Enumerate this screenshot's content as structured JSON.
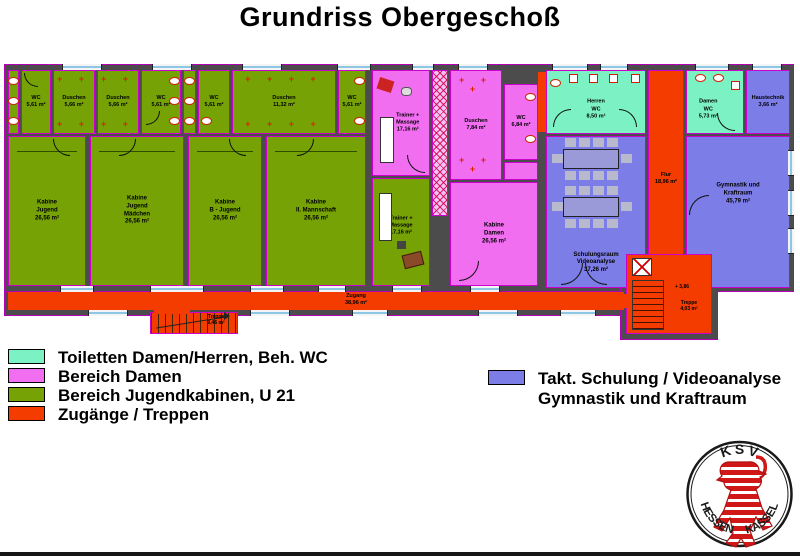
{
  "title": "Grundriss Obergeschoß",
  "palette": {
    "toiletten": "#7cf2c4",
    "damen": "#f16ef1",
    "jugend": "#76a206",
    "zugang": "#f43c00",
    "schulung": "#7d7de8",
    "wall": "#4c4c4c",
    "room_border": "#cc00cc",
    "window_glass": "#8ec6e6"
  },
  "legend": {
    "items": [
      {
        "label": "Toiletten Damen/Herren, Beh. WC",
        "key": "toiletten"
      },
      {
        "label": "Bereich Damen",
        "key": "damen"
      },
      {
        "label": "Bereich Jugendkabinen, U 21",
        "key": "jugend"
      },
      {
        "label": "Zugänge / Treppen",
        "key": "zugang"
      }
    ],
    "right": {
      "line1": "Takt. Schulung / Videoanalyse",
      "line2": "Gymnastik und Kraftraum",
      "key": "schulung"
    }
  },
  "rooms": {
    "wc1": "WC\n5,61 m²",
    "du1": "Duschen\n5,66 m²",
    "du2": "Duschen\n5,66 m²",
    "wc2": "WC\n5,61 m²",
    "wc3": "WC\n5,61 m²",
    "du_big": "Duschen\n11,32 m²",
    "wc4": "WC\n5,61 m²",
    "kab1": "Kabine\nJugend\n26,56 m²",
    "kab2": "Kabine\nJugend\nMädchen\n26,56 m²",
    "kab3": "Kabine\nB - Jugend\n26,56 m²",
    "kab4": "Kabine\nII. Mannschaft\n26,56 m²",
    "trainer1": "Trainer +\nMassage\n17,16 m²",
    "trainer2": "Trainer +\nMassage\n17,16 m²",
    "du_damen": "Duschen\n7,84 m²",
    "wc_damen": "WC\n6,84 m²",
    "kab_damen": "Kabine\nDamen\n26,56 m²",
    "herren_wc": "Herren\nWC\n8,50 m²",
    "damen_wc": "Damen\nWC\n5,73 m²",
    "haustechnik": "Haustechnik\n3,66 m²",
    "flur": "Flur\n18,96 m²",
    "schulungsraum": "Schulungsraum\nVideoanalyse\n37,26 m²",
    "gymnastik": "Gymnastik und\nKraftraum\n45,79 m²",
    "zugang": "Zugang\n38,96 m²",
    "treppe_links": "Treppe\n9,46 m²",
    "treppe_rechts": "Treppe\n4,03 m²"
  },
  "annotations": {
    "level": "+ 3,86"
  },
  "symbols": {
    "row2": "+ +",
    "row3": "+ + +",
    "row4": "+ + + +"
  },
  "logo": {
    "top": "KSV",
    "bottom_left": "HESSEN",
    "bottom_right": "KASSEL"
  }
}
